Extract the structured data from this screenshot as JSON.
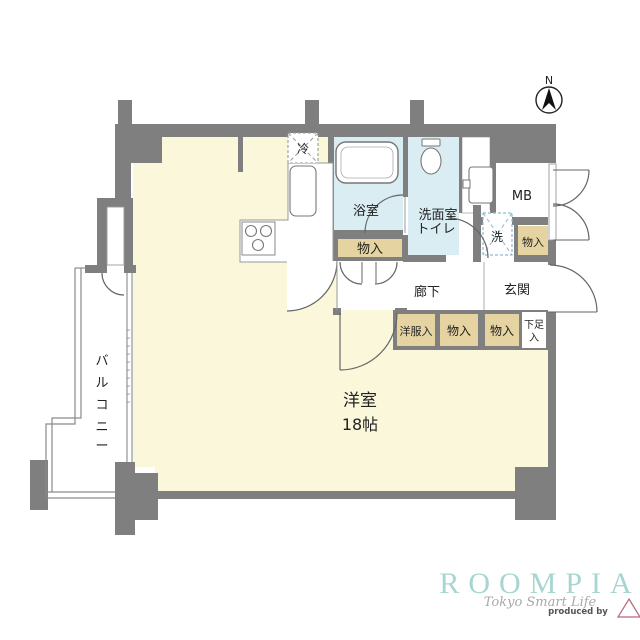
{
  "compass": {
    "north": "N"
  },
  "rooms": {
    "living": {
      "name": "洋室",
      "size": "18帖"
    },
    "bathroom": "浴室",
    "washroom_line1": "洗面室",
    "washroom_line2": "トイレ",
    "corridor": "廊下",
    "entrance": "玄関",
    "meter_box": "MB",
    "balcony": {
      "label": "バルコニー",
      "chars": [
        "バ",
        "ル",
        "コ",
        "ニ",
        "ー"
      ]
    }
  },
  "fixtures": {
    "refrigerator": "冷",
    "washer": "洗"
  },
  "storage": {
    "bath_side": "物入",
    "washer_side": "物入",
    "clothes": "洋服入",
    "hall_1": "物入",
    "hall_2": "物入",
    "shoe_line1": "下足",
    "shoe_line2": "入"
  },
  "branding": {
    "brand": "ROOMPIA",
    "tagline": "Tokyo Smart Life",
    "produced_by": "produced by"
  },
  "colors": {
    "wall_gray": "#7f7f7f",
    "room_cream": "#faf7db",
    "wet_area_blue": "#d9edf3",
    "closet_tan": "#e5d3a1",
    "brand_teal": "#a7d6d1",
    "washer_dash_blue": "#8fb9cf"
  }
}
